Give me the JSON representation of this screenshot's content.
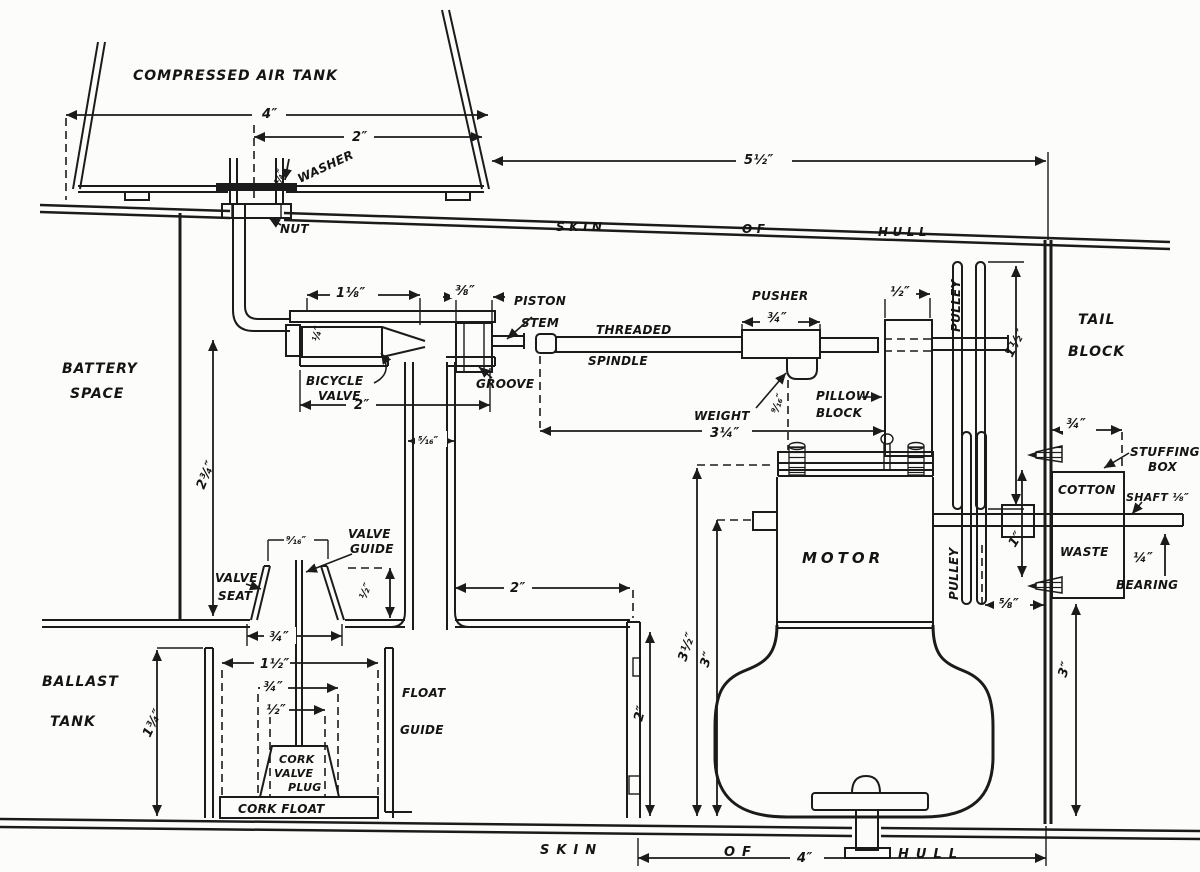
{
  "palette": {
    "ink": "#1b1b1b",
    "paper": "#fcfcfa"
  },
  "labels": {
    "tank": "COMPRESSED AIR TANK",
    "washer": "WASHER",
    "nut": "NUT",
    "hull_top": {
      "a": "SKIN",
      "b": "OF",
      "c": "HULL"
    },
    "hull_bottom": {
      "a": "SKIN",
      "b": "OF",
      "c": "HULL"
    },
    "battery1": "BATTERY",
    "battery2": "SPACE",
    "bicycle1": "BICYCLE",
    "bicycle2": "VALVE",
    "piston1": "PISTON",
    "piston2": "STEM",
    "groove": "GROOVE",
    "threaded1": "THREADED",
    "threaded2": "SPINDLE",
    "pusher": "PUSHER",
    "weight": "WEIGHT",
    "pillow1": "PILLOW",
    "pillow2": "BLOCK",
    "pulley_upper": "PULLEY",
    "pulley_lower": "PULLEY",
    "tail1": "TAIL",
    "tail2": "BLOCK",
    "stuffing1": "STUFFING",
    "stuffing2": "BOX",
    "cotton": "COTTON",
    "waste": "WASTE",
    "shaft": "SHAFT ⅛″",
    "bearing": "BEARING",
    "motor": "MOTOR",
    "valve_seat1": "VALVE",
    "valve_seat2": "SEAT",
    "valve_guide1": "VALVE",
    "valve_guide2": "GUIDE",
    "ballast1": "BALLAST",
    "ballast2": "TANK",
    "float1": "FLOAT",
    "float2": "GUIDE",
    "cork1": "CORK",
    "cork2": "VALVE",
    "cork3": "PLUG",
    "cork_float": "CORK  FLOAT"
  },
  "dims": {
    "tank_w": "4″",
    "tank_neck": "2″",
    "hull_span": "5½″",
    "washer_t": "¼″",
    "valve_len": "1⅛″",
    "groove_w": "⅜″",
    "valve_body": "2″",
    "valve_bore": "¼″",
    "tube_w": "⁵⁄₁₆″",
    "drop": "2¾″",
    "pusher_w": "¾″",
    "weight_drop": "⁹⁄₁₆″",
    "spindle_span": "3¼″",
    "pillow_w": "½″",
    "pulley_d": "1½″",
    "stuff_w": "¾″",
    "shaft_len": "1″",
    "pulley_gap": "⅝″",
    "bearing_t": "¼″",
    "motor_h1": "3½″",
    "motor_h2": "3″",
    "tail_h": "3″",
    "motor_base": "4″",
    "seat_top": "⁹⁄₁₆″",
    "seat_bot": "¾″",
    "guide_h": "½″",
    "tube_span": "2″",
    "float_h": "1¾″",
    "float_w1": "1½″",
    "float_w2": "¾″",
    "float_w3": "½″",
    "guide_wall": "2″"
  }
}
